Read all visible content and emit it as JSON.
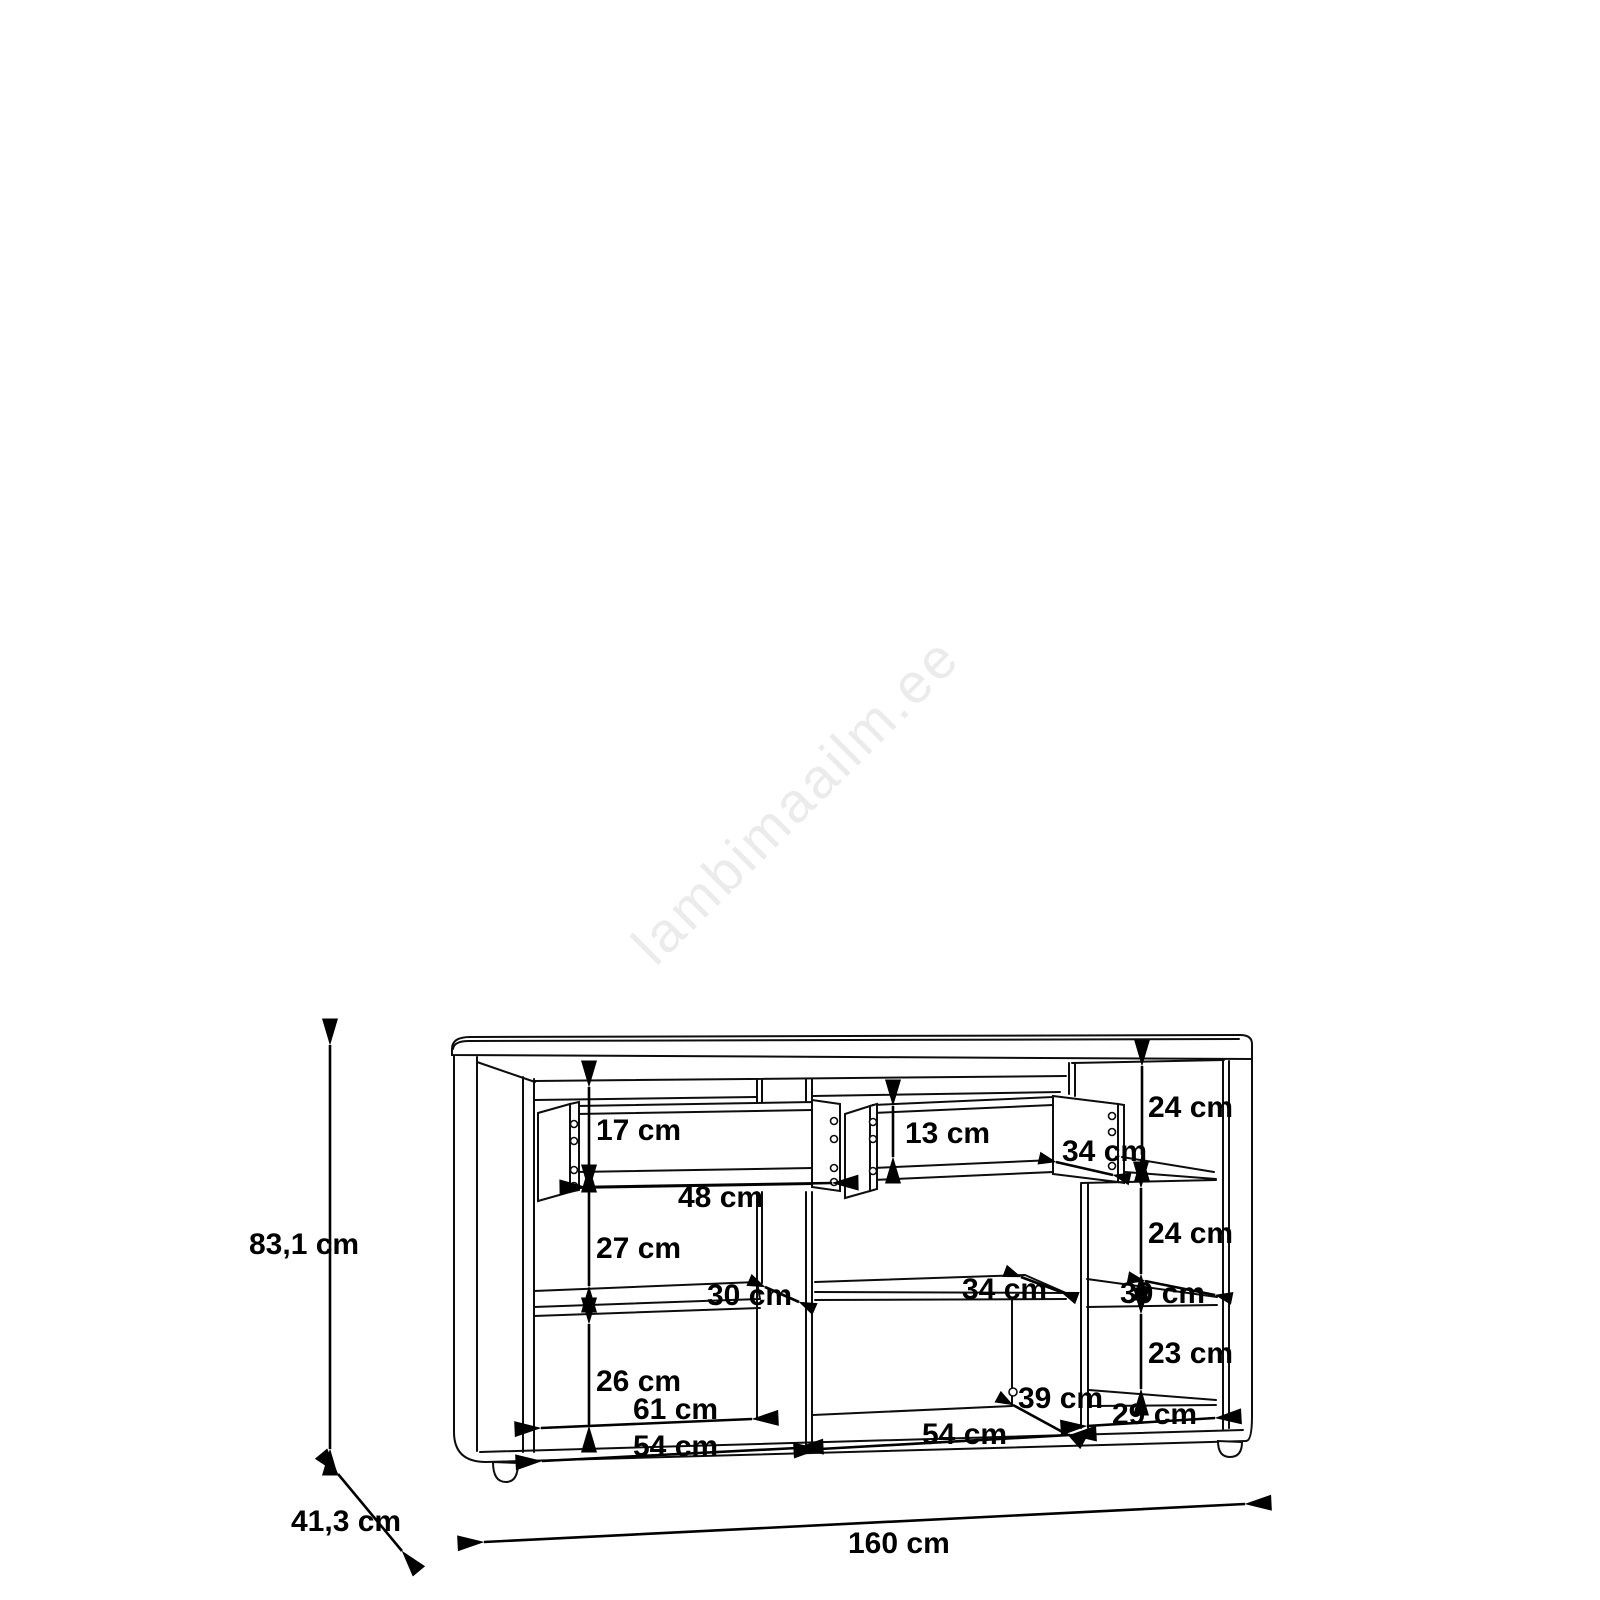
{
  "diagram": {
    "watermark": "lambimaailm.ee",
    "overall": {
      "height": "83,1 cm",
      "depth": "41,3 cm",
      "width": "160 cm"
    },
    "labels": {
      "left_drawer_height": "17 cm",
      "left_drawer_width": "48 cm",
      "left_gap_upper": "27 cm",
      "left_shelf_depth": "30 cm",
      "left_gap_lower": "26 cm",
      "left_floor_depth": "61 cm",
      "left_compartment_width": "54 cm",
      "right_drawer_height": "13 cm",
      "right_drawer_depth": "34 cm",
      "middle_shelf_depth": "34 cm",
      "middle_compartment_width": "54 cm",
      "middle_floor_depth": "39 cm",
      "right_gap_top": "24 cm",
      "right_gap_mid": "24 cm",
      "right_shelf_depth": "39 cm",
      "right_gap_lower": "23 cm",
      "right_compartment_width": "29 cm"
    }
  }
}
